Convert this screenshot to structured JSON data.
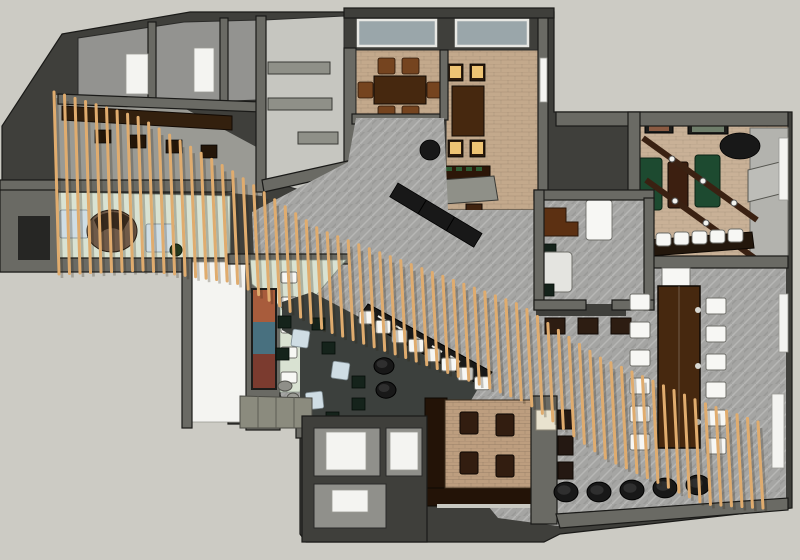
{
  "scene": {
    "type": "3d-floor-plan-render",
    "view": "top-down axonometric",
    "rooms": [
      {
        "name": "storage-rooms-top-left"
      },
      {
        "name": "kitchen"
      },
      {
        "name": "private-dining-room-1",
        "tables": 1,
        "chairs": 6
      },
      {
        "name": "private-dining-room-2",
        "tables": 1,
        "lit-chairs": 4
      },
      {
        "name": "game-room",
        "pool-tables": 2,
        "bar-stools": 5,
        "light-beams": 2,
        "wall-pictures": 2
      },
      {
        "name": "office-room"
      },
      {
        "name": "entry-reception",
        "desks": 1,
        "counters": 2
      },
      {
        "name": "corridor"
      },
      {
        "name": "lounge",
        "tables": 3,
        "stools": 8,
        "ottomans": 2
      },
      {
        "name": "mural-wall",
        "panels": 3
      },
      {
        "name": "booth-area",
        "armchairs": 4
      },
      {
        "name": "restroom-extension",
        "rooms": 3
      },
      {
        "name": "main-hall",
        "communal-table-chairs": 12,
        "bar-row-chairs": 8,
        "floor-poufs": 5
      }
    ]
  },
  "palette": {
    "bg": "#cccbc4",
    "line": "#1a1a18",
    "wallMid": "#6a6a64",
    "wallDark": "#3f3f3b",
    "wallLight": "#9a9a94",
    "floorGray": "#a5a5a3",
    "floorTan": "#c3a98c",
    "floorBeige": "#c9b197",
    "floorMint": "#d9e2d2",
    "floorWhite": "#f4f4f1",
    "floorDark": "#3c403d",
    "floorConcrete": "#c6c6c0",
    "slat": "#e0ac6e",
    "slatShadow": "rgba(40,30,15,0.25)",
    "woodDark": "#46280f",
    "woodMid": "#5c3012",
    "woodChair": "#75441f",
    "greenTable": "#1d4a30",
    "litSeat": "#eec474",
    "blueTable": "#cfdde4",
    "whiteFurn": "#f7f7f4",
    "blackFurn": "#181818",
    "brickFloor": "#bd9e7f",
    "boothWood": "#231307",
    "muralRust": "#a85c3c",
    "muralTeal": "#48707f",
    "muralMaroon": "#7b3b2f",
    "cream": "#e9e3cf"
  },
  "ribbon": {
    "count": 68,
    "x0": 54,
    "x1": 758,
    "lean": 5,
    "top": [
      [
        54,
        92
      ],
      [
        140,
        118
      ],
      [
        230,
        170
      ],
      [
        320,
        230
      ],
      [
        420,
        268
      ],
      [
        520,
        305
      ],
      [
        600,
        358
      ],
      [
        700,
        402
      ],
      [
        758,
        422
      ]
    ],
    "len": [
      [
        54,
        182
      ],
      [
        140,
        152
      ],
      [
        230,
        112
      ],
      [
        320,
        100
      ],
      [
        420,
        96
      ],
      [
        520,
        96
      ],
      [
        600,
        100
      ],
      [
        700,
        102
      ],
      [
        758,
        86
      ]
    ]
  },
  "communal": {
    "left_x": 630,
    "right_x": 706,
    "ys": [
      294,
      322,
      350,
      378,
      406,
      434
    ],
    "w": 20,
    "h": 16
  },
  "bar_row": {
    "count": 8,
    "x0": 359,
    "y0": 311,
    "dx": 16.5,
    "dy": 9.4,
    "w": 15,
    "h": 13
  },
  "poufs": [
    [
      566,
      492,
      12
    ],
    [
      599,
      492,
      12
    ],
    [
      632,
      490,
      12
    ],
    [
      665,
      488,
      12
    ],
    [
      698,
      485,
      12
    ],
    [
      384,
      366,
      10
    ],
    [
      386,
      390,
      10
    ]
  ]
}
